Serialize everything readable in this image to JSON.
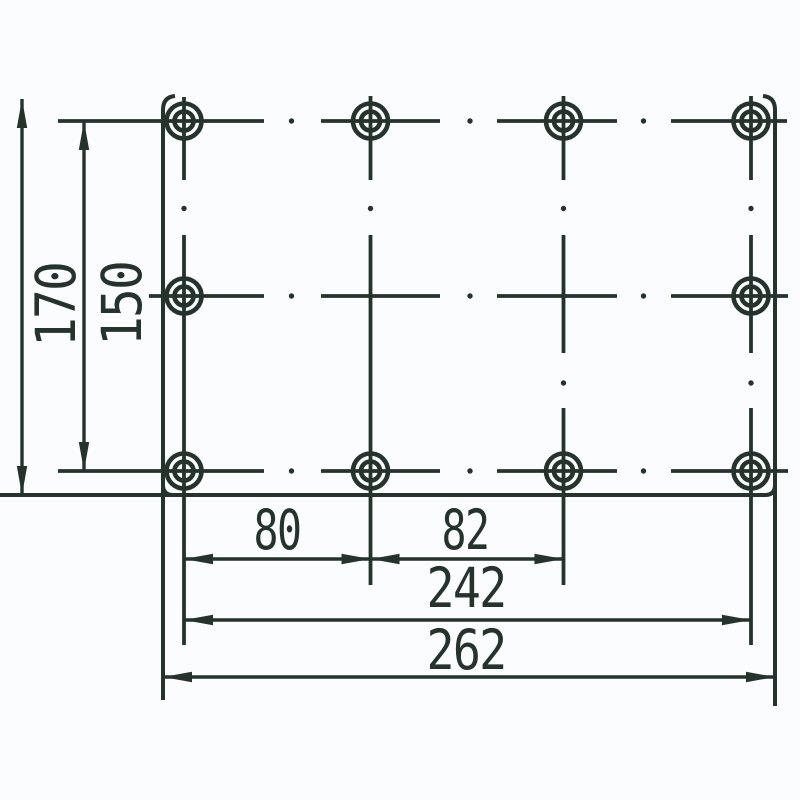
{
  "canvas": {
    "background": "#fbfcfd",
    "stroke_color": "#26332c",
    "content": "technical dimensioned drawing of mounting plate with hole pattern"
  },
  "dimensions": {
    "plate_height": "170",
    "hole_rows_span": "150",
    "hole_gap_left": "80",
    "hole_gap_mid": "82",
    "hole_cols_span": "242",
    "plate_width": "262"
  }
}
